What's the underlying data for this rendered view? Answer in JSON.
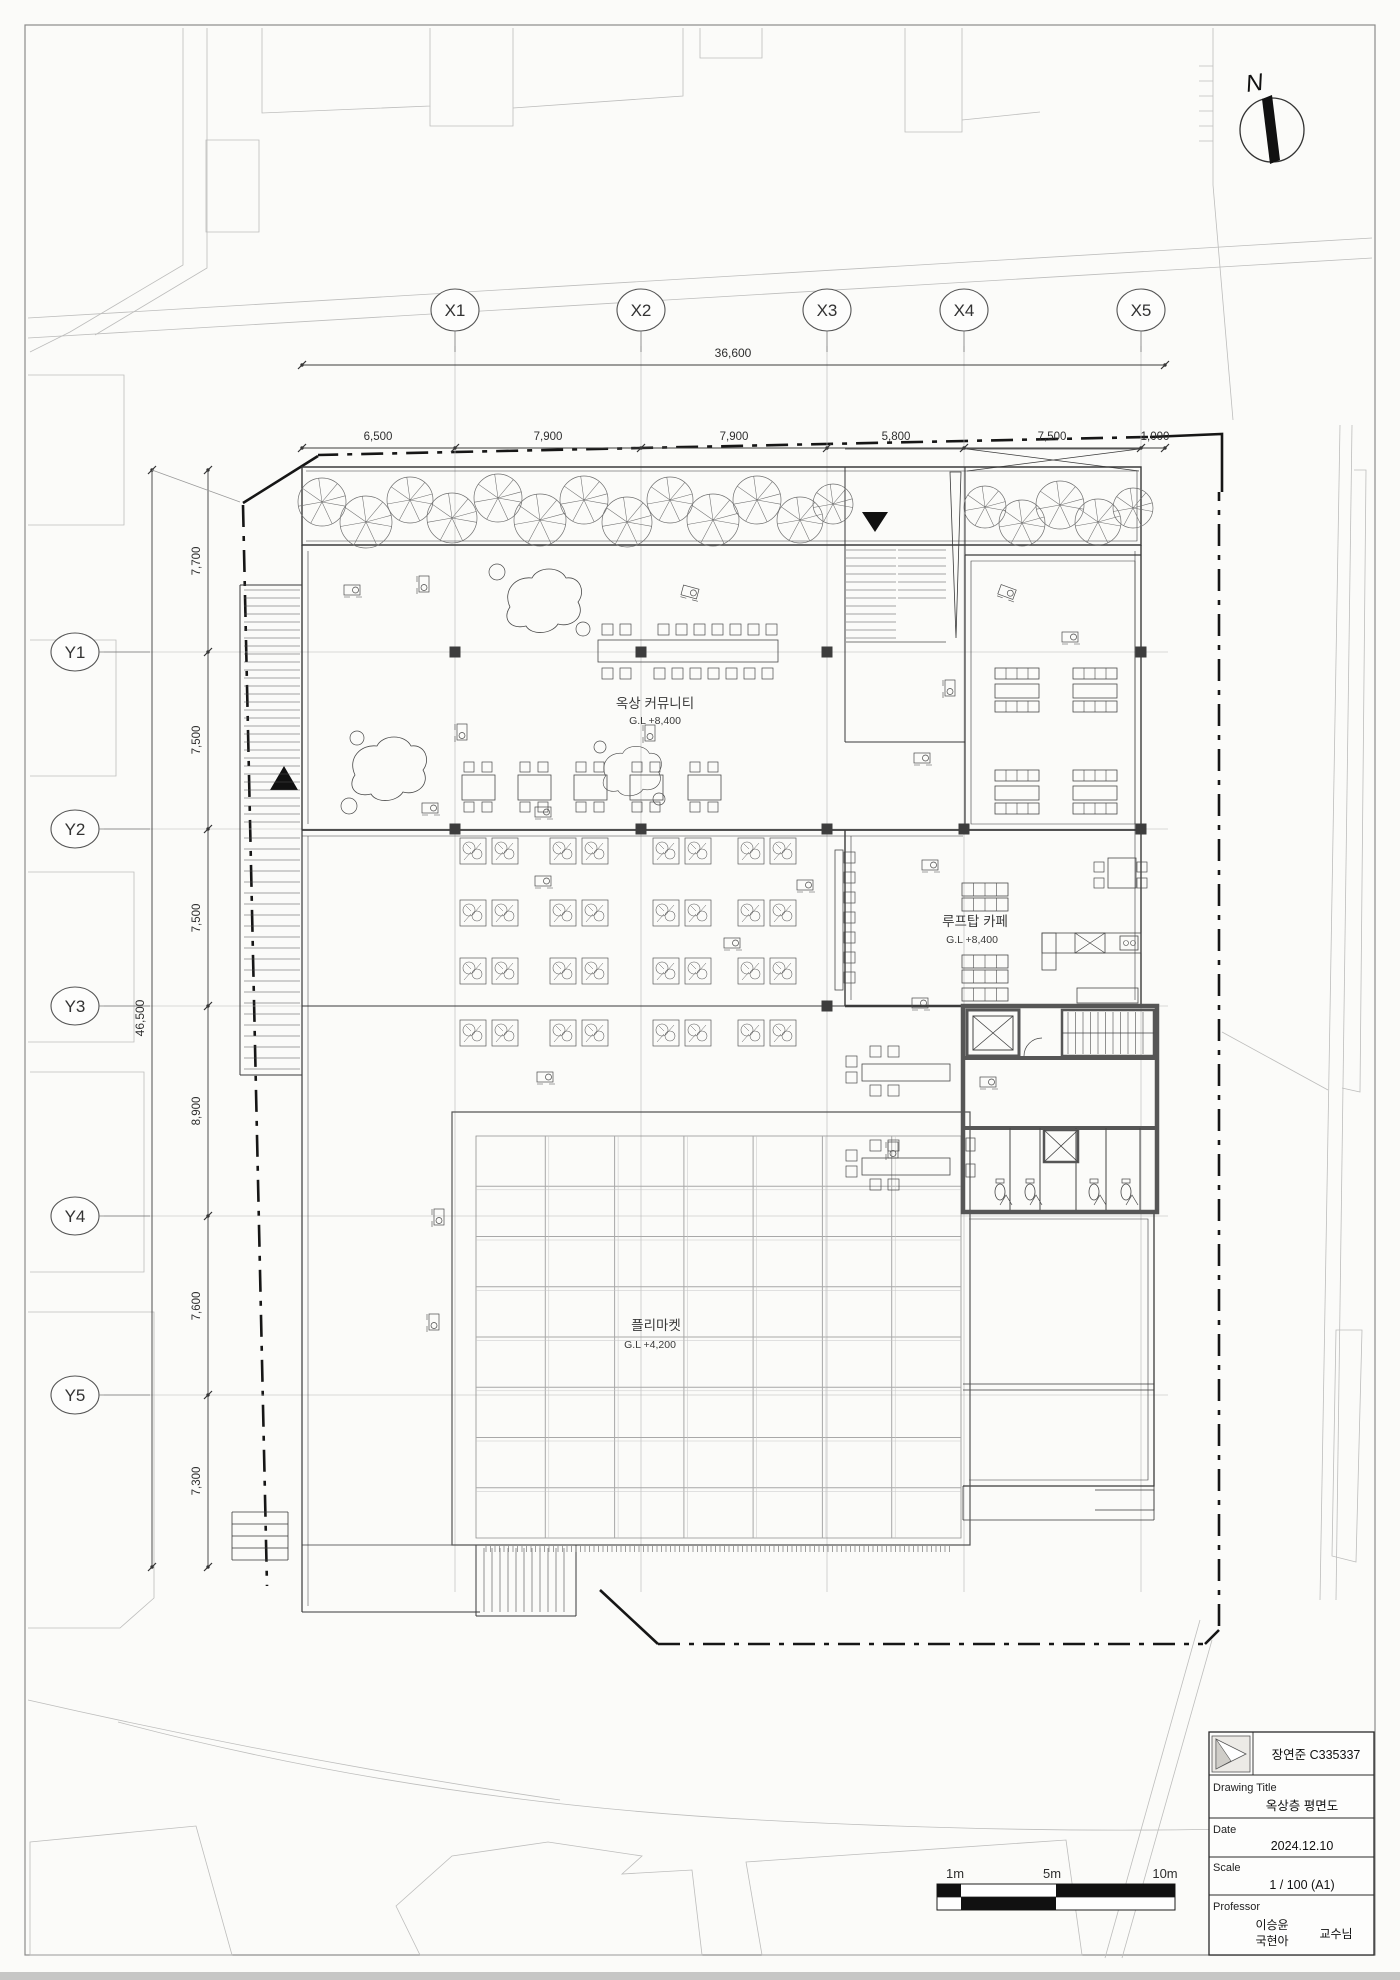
{
  "sheet": {
    "north_label": "N"
  },
  "grid": {
    "x_labels": [
      "X1",
      "X2",
      "X3",
      "X4",
      "X5"
    ],
    "y_labels": [
      "Y1",
      "Y2",
      "Y3",
      "Y4",
      "Y5"
    ]
  },
  "dims": {
    "h_total": "36,600",
    "h_segments": [
      "6,500",
      "7,900",
      "7,900",
      "5,800",
      "7,500",
      "1,000"
    ],
    "v_total": "46,500",
    "v_segments": [
      "7,700",
      "7,500",
      "7,500",
      "8,900",
      "7,600",
      "7,300"
    ]
  },
  "rooms": {
    "community": {
      "name": "옥상 커뮤니티",
      "level": "G.L +8,400"
    },
    "cafe": {
      "name": "루프탑 카페",
      "level": "G.L +8,400"
    },
    "market": {
      "name": "플리마켓",
      "level": "G.L +4,200"
    }
  },
  "scale_bar": {
    "labels": [
      "1m",
      "5m",
      "10m"
    ]
  },
  "title_block": {
    "author": "장연준 C335337",
    "drawing_title_label": "Drawing Title",
    "drawing_title": "옥상층 평면도",
    "date_label": "Date",
    "date": "2024.12.10",
    "scale_label": "Scale",
    "scale": "1 / 100 (A1)",
    "professor_label": "Professor",
    "professor_name_1": "이승윤",
    "professor_name_2": "국현아",
    "professor_suffix": "교수님"
  }
}
